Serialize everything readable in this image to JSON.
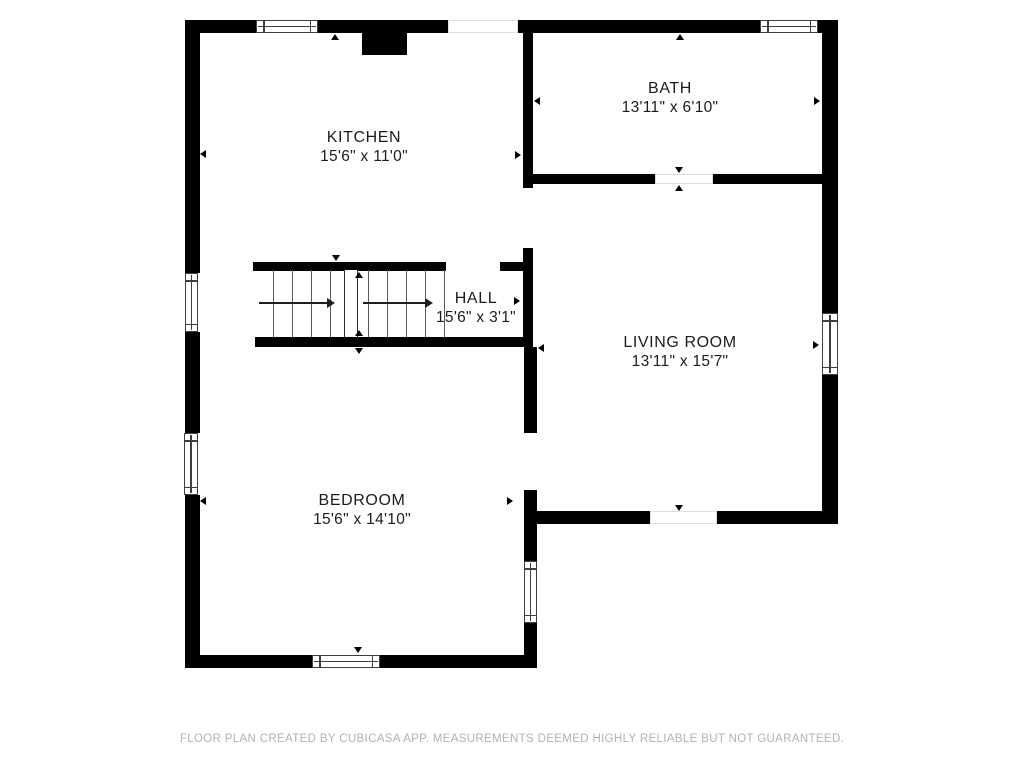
{
  "rooms": {
    "kitchen": {
      "name": "KITCHEN",
      "dimensions": "15'6\" x 11'0\""
    },
    "bath": {
      "name": "BATH",
      "dimensions": "13'11\" x 6'10\""
    },
    "hall": {
      "name": "HALL",
      "dimensions": "15'6\" x 3'1\""
    },
    "living_room": {
      "name": "LIVING ROOM",
      "dimensions": "13'11\" x 15'7\""
    },
    "bedroom": {
      "name": "BEDROOM",
      "dimensions": "15'6\" x 14'10\""
    }
  },
  "footer": {
    "disclaimer": "FLOOR PLAN CREATED BY CUBICASA APP. MEASUREMENTS DEEMED HIGHLY RELIABLE BUT NOT GUARANTEED."
  },
  "colors": {
    "wall": "#000000",
    "background": "#ffffff",
    "label_text": "#1c1c1c",
    "footer_text": "#b2b2b2"
  }
}
